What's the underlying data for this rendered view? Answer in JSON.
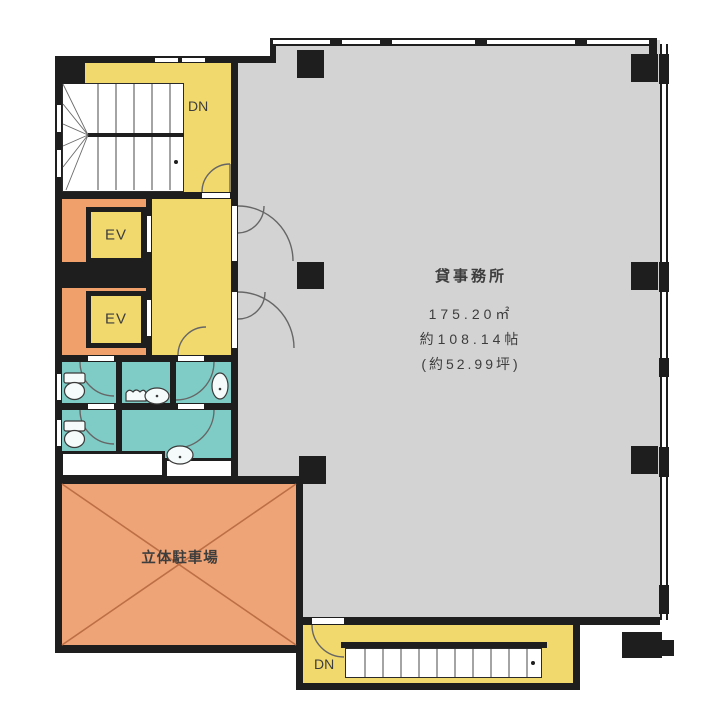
{
  "rooms": {
    "office": {
      "label": "貸事務所",
      "area_m2": "175.20㎡",
      "area_jo": "約108.14帖",
      "area_tsubo": "(約52.99坪)"
    },
    "parking": {
      "label": "立体駐車場"
    },
    "elevators": [
      {
        "label": "EV"
      },
      {
        "label": "EV"
      }
    ],
    "stairwells": [
      {
        "label": "DN"
      },
      {
        "label": "DN"
      }
    ]
  },
  "colors": {
    "wall": "#1e1e1e",
    "office_floor": "#d3d3d3",
    "corridor_yellow": "#f1d96d",
    "shaft_orange": "#efa06b",
    "sanitary_teal": "#7fccc6",
    "parking_orange": "#efa477",
    "parking_line": "#bc6f45",
    "door_line": "#666666",
    "text": "#3d3d3d"
  }
}
